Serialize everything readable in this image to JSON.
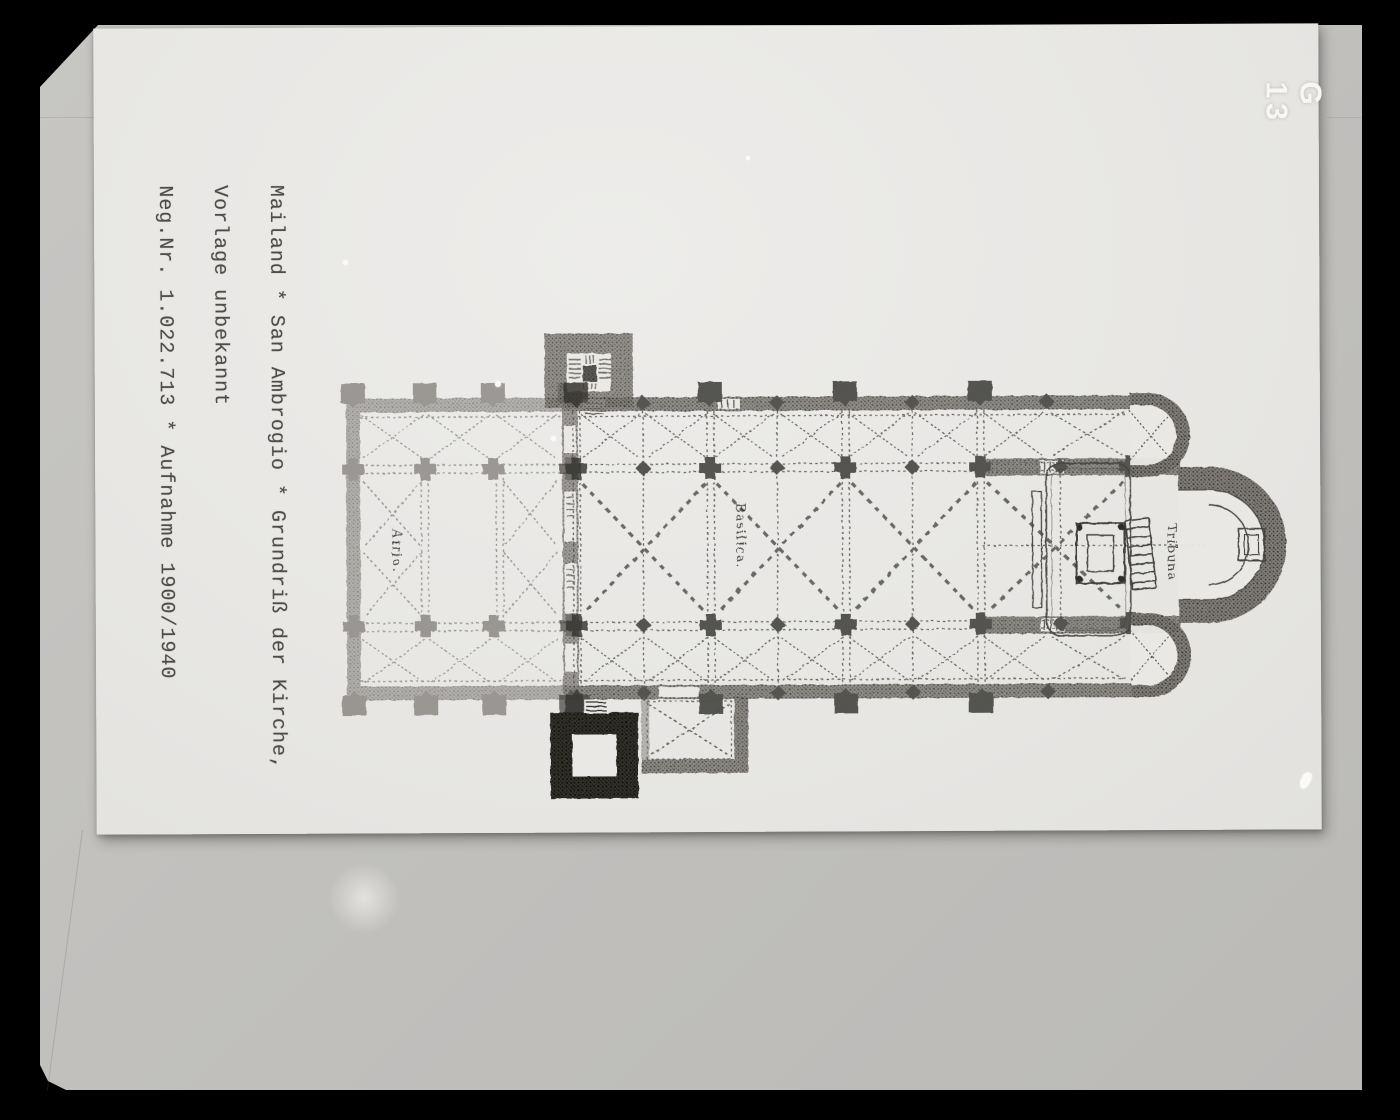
{
  "archive_photo": {
    "shelf_mark": "G 13",
    "caption": {
      "line1": "Mailand * San Ambrogio * Grundriß der Kirche,",
      "line2": "Vorlage unbekannt",
      "line3": "Neg.Nr. 1.022.713 * Aufnahme 1900/1940"
    },
    "plan_labels": {
      "atrio": "Atrio.",
      "basilica": "Basilica.",
      "tribuna": "Tribuna"
    },
    "colors": {
      "frame_black": "#000000",
      "mount_gray": "#c1c0bd",
      "card_white": "#e9e8e5",
      "plan_ink": "#3a3835",
      "caption_ink": "#4e4c49",
      "shelf_mark_white": "#f8f7f4"
    }
  }
}
